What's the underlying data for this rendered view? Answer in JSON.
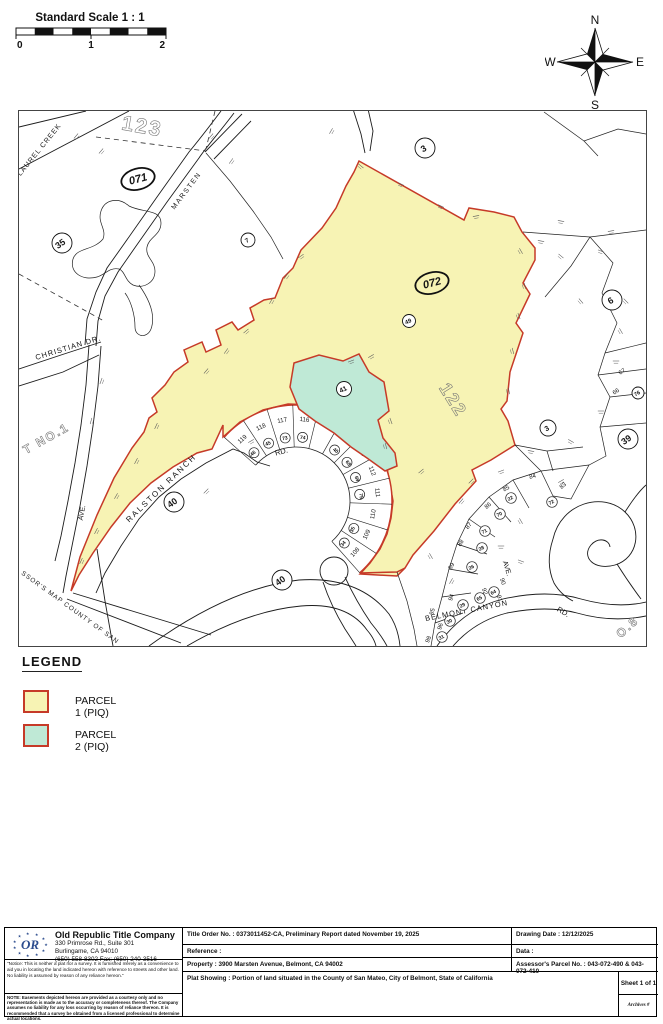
{
  "header": {
    "scale_title": "Standard Scale 1 : 1",
    "scale_ticks": [
      "0",
      "1",
      "2"
    ]
  },
  "compass": {
    "north": "N",
    "south": "S",
    "east": "E",
    "west": "W"
  },
  "map": {
    "parcel1_color": "#f7f3b4",
    "parcel2_color": "#bfe9d6",
    "boundary_color": "#c63a28",
    "street_labels": [
      {
        "t": "LAUREL CREEK",
        "x": 40,
        "y": 150,
        "r": -51,
        "s": 7,
        "sp": 1
      },
      {
        "t": "MARSTEN",
        "x": 187,
        "y": 191,
        "r": -53,
        "s": 7,
        "sp": 1.5
      },
      {
        "t": "CHRISTIAN  DR.",
        "x": 68,
        "y": 349,
        "r": -17,
        "s": 7.5,
        "sp": 1
      },
      {
        "t": "RALSTON  RANCH",
        "x": 162,
        "y": 489,
        "r": -44,
        "s": 8,
        "sp": 2
      },
      {
        "t": "RD.",
        "x": 281,
        "y": 453,
        "r": -15,
        "s": 7.5
      },
      {
        "t": "BELMONT  CANYON",
        "x": 466,
        "y": 612,
        "r": -11,
        "s": 7.5,
        "sp": 1
      },
      {
        "t": "RD.",
        "x": 561,
        "y": 613,
        "r": 30,
        "s": 7.5
      },
      {
        "t": "AVE.",
        "x": 83,
        "y": 512,
        "r": -80,
        "s": 7
      },
      {
        "t": "AVE.",
        "x": 504,
        "y": 568,
        "r": 73,
        "s": 7
      }
    ],
    "area_labels": [
      {
        "t": "123",
        "x": 140,
        "y": 132,
        "r": 10,
        "s": 21,
        "o": 1
      },
      {
        "t": "122",
        "x": 447,
        "y": 402,
        "r": 58,
        "s": 18,
        "o": 1
      },
      {
        "t": "T  NO.1",
        "x": 47,
        "y": 441,
        "r": -29,
        "s": 12,
        "o": 1
      },
      {
        "t": "SSOR'S MAP COUNTY OF SAN",
        "x": 68,
        "y": 608,
        "r": 36,
        "s": 6.5,
        "o": 0
      },
      {
        "t": "O.8",
        "x": 629,
        "y": 629,
        "r": -42,
        "s": 12,
        "o": 1
      }
    ],
    "oval_labels": [
      {
        "t": "071",
        "x": 137,
        "y": 178,
        "r": -15
      },
      {
        "t": "072",
        "x": 431,
        "y": 282,
        "r": -15
      }
    ],
    "circle_labels": [
      {
        "t": "35",
        "x": 61,
        "y": 242,
        "rad": 10,
        "r": -35
      },
      {
        "t": "7",
        "x": 247,
        "y": 239,
        "rad": 7,
        "r": -30
      },
      {
        "t": "3",
        "x": 424,
        "y": 147,
        "rad": 10,
        "r": -30
      },
      {
        "t": "6",
        "x": 611,
        "y": 299,
        "rad": 10,
        "r": -30
      },
      {
        "t": "49",
        "x": 408,
        "y": 320,
        "rad": 6.5,
        "r": -25
      },
      {
        "t": "41",
        "x": 343,
        "y": 388,
        "rad": 7.5,
        "r": -25
      },
      {
        "t": "3",
        "x": 547,
        "y": 427,
        "rad": 8,
        "r": -30
      },
      {
        "t": "39",
        "x": 627,
        "y": 438,
        "rad": 10,
        "r": -35
      },
      {
        "t": "40",
        "x": 173,
        "y": 501,
        "rad": 10,
        "r": -35
      },
      {
        "t": "40",
        "x": 281,
        "y": 579,
        "rad": 10,
        "r": -35
      },
      {
        "t": "76",
        "x": 637,
        "y": 392,
        "rad": 6,
        "r": -30
      }
    ],
    "lot_labels": [
      {
        "t": "84",
        "x": 532,
        "y": 477,
        "r": -15
      },
      {
        "t": "83",
        "x": 563,
        "y": 486,
        "r": -40
      },
      {
        "t": "85",
        "x": 506,
        "y": 489,
        "r": -30
      },
      {
        "t": "86",
        "x": 488,
        "y": 506,
        "r": -40
      },
      {
        "t": "87",
        "x": 469,
        "y": 526,
        "r": -50
      },
      {
        "t": "88",
        "x": 461,
        "y": 543,
        "r": -55
      },
      {
        "t": "89",
        "x": 452,
        "y": 566,
        "r": -62
      },
      {
        "t": "90",
        "x": 500,
        "y": 581,
        "r": 72
      },
      {
        "t": "91",
        "x": 497,
        "y": 598,
        "r": 70
      },
      {
        "t": "92",
        "x": 482,
        "y": 591,
        "r": 70
      },
      {
        "t": "94",
        "x": 452,
        "y": 597,
        "r": -72
      },
      {
        "t": "95",
        "x": 433,
        "y": 611,
        "r": -75
      },
      {
        "t": "96",
        "x": 441,
        "y": 626,
        "r": -72
      },
      {
        "t": "98",
        "x": 429,
        "y": 639,
        "r": -68
      },
      {
        "t": "67",
        "x": 622,
        "y": 372,
        "r": -35
      },
      {
        "t": "66",
        "x": 616,
        "y": 392,
        "r": -35
      }
    ],
    "circled_lots": [
      {
        "t": "22",
        "x": 510,
        "y": 497
      },
      {
        "t": "72",
        "x": 551,
        "y": 501
      },
      {
        "t": "70",
        "x": 499,
        "y": 513
      },
      {
        "t": "71",
        "x": 484,
        "y": 530
      },
      {
        "t": "28",
        "x": 481,
        "y": 547
      },
      {
        "t": "26",
        "x": 471,
        "y": 566
      },
      {
        "t": "29",
        "x": 462,
        "y": 604
      },
      {
        "t": "30",
        "x": 449,
        "y": 620
      },
      {
        "t": "31",
        "x": 441,
        "y": 636
      },
      {
        "t": "64",
        "x": 493,
        "y": 591
      },
      {
        "t": "65",
        "x": 479,
        "y": 597
      }
    ],
    "fan": {
      "cx": 295,
      "cy": 500,
      "rIn": 54,
      "rOut": 96,
      "rLab": 80,
      "rCirc": 64,
      "a0": -131,
      "a1": 41,
      "half": 7.4
    },
    "fan_lots": [
      {
        "n": "119",
        "c": "46"
      },
      {
        "n": "118",
        "c": "45"
      },
      {
        "n": "117",
        "c": "73"
      },
      {
        "n": "116",
        "c": "74"
      },
      {
        "n": "115",
        "c": ""
      },
      {
        "n": "114",
        "c": "40"
      },
      {
        "n": "113",
        "c": "68"
      },
      {
        "n": "112",
        "c": "69"
      },
      {
        "n": "111",
        "c": "75"
      },
      {
        "n": "110",
        "c": ""
      },
      {
        "n": "109",
        "c": "35"
      },
      {
        "n": "108",
        "c": "34"
      }
    ]
  },
  "legend": {
    "title": "LEGEND",
    "items": [
      {
        "label": "PARCEL 1 (PIQ)",
        "color": "#f7f3b4"
      },
      {
        "label": "PARCEL 2 (PIQ)",
        "color": "#bfe9d6"
      }
    ]
  },
  "titleblock": {
    "company_name": "Old Republic Title Company",
    "address1": "330 Primrose Rd., Suite 301",
    "address2": "Burlingame, CA 94010",
    "phone": "(650) 558-8302 Fax: (650) 240-3516",
    "notice": "\"Notice: This is neither a plat nor a survey. It is furnished merely as a convenience to aid you in locating the land indicated hereon with reference to streets and other land. No liability is assumed by reason of any reliance hereon.\"",
    "note": "NOTE: Easements depicted hereon are provided as a courtesy only and no representation is made as to the accuracy or complete­ness thereof. The Company assumes no liability for any loss occurring by reason of reliance thereon. It is recommended that a survey be obtained from a licensed professional to determine actual locations.",
    "title_order": "Title Order No. : 0373011452-CA, Preliminary Report dated November 19, 2025",
    "reference": "Reference :",
    "property": "Property : 3900 Marsten Avenue, Belmont, CA 94002",
    "plat_showing": "Plat Showing : Portion of land situated in the County of San Mateo, City of Belmont, State of California",
    "drawing_date": "Drawing Date : 12/12/2025",
    "data_label": "Data :",
    "apn": "Assessor's Parcel No. : 043-072-490 & 043-072-410",
    "sheet": "Sheet 1 of 1",
    "archives": "Archives #"
  }
}
